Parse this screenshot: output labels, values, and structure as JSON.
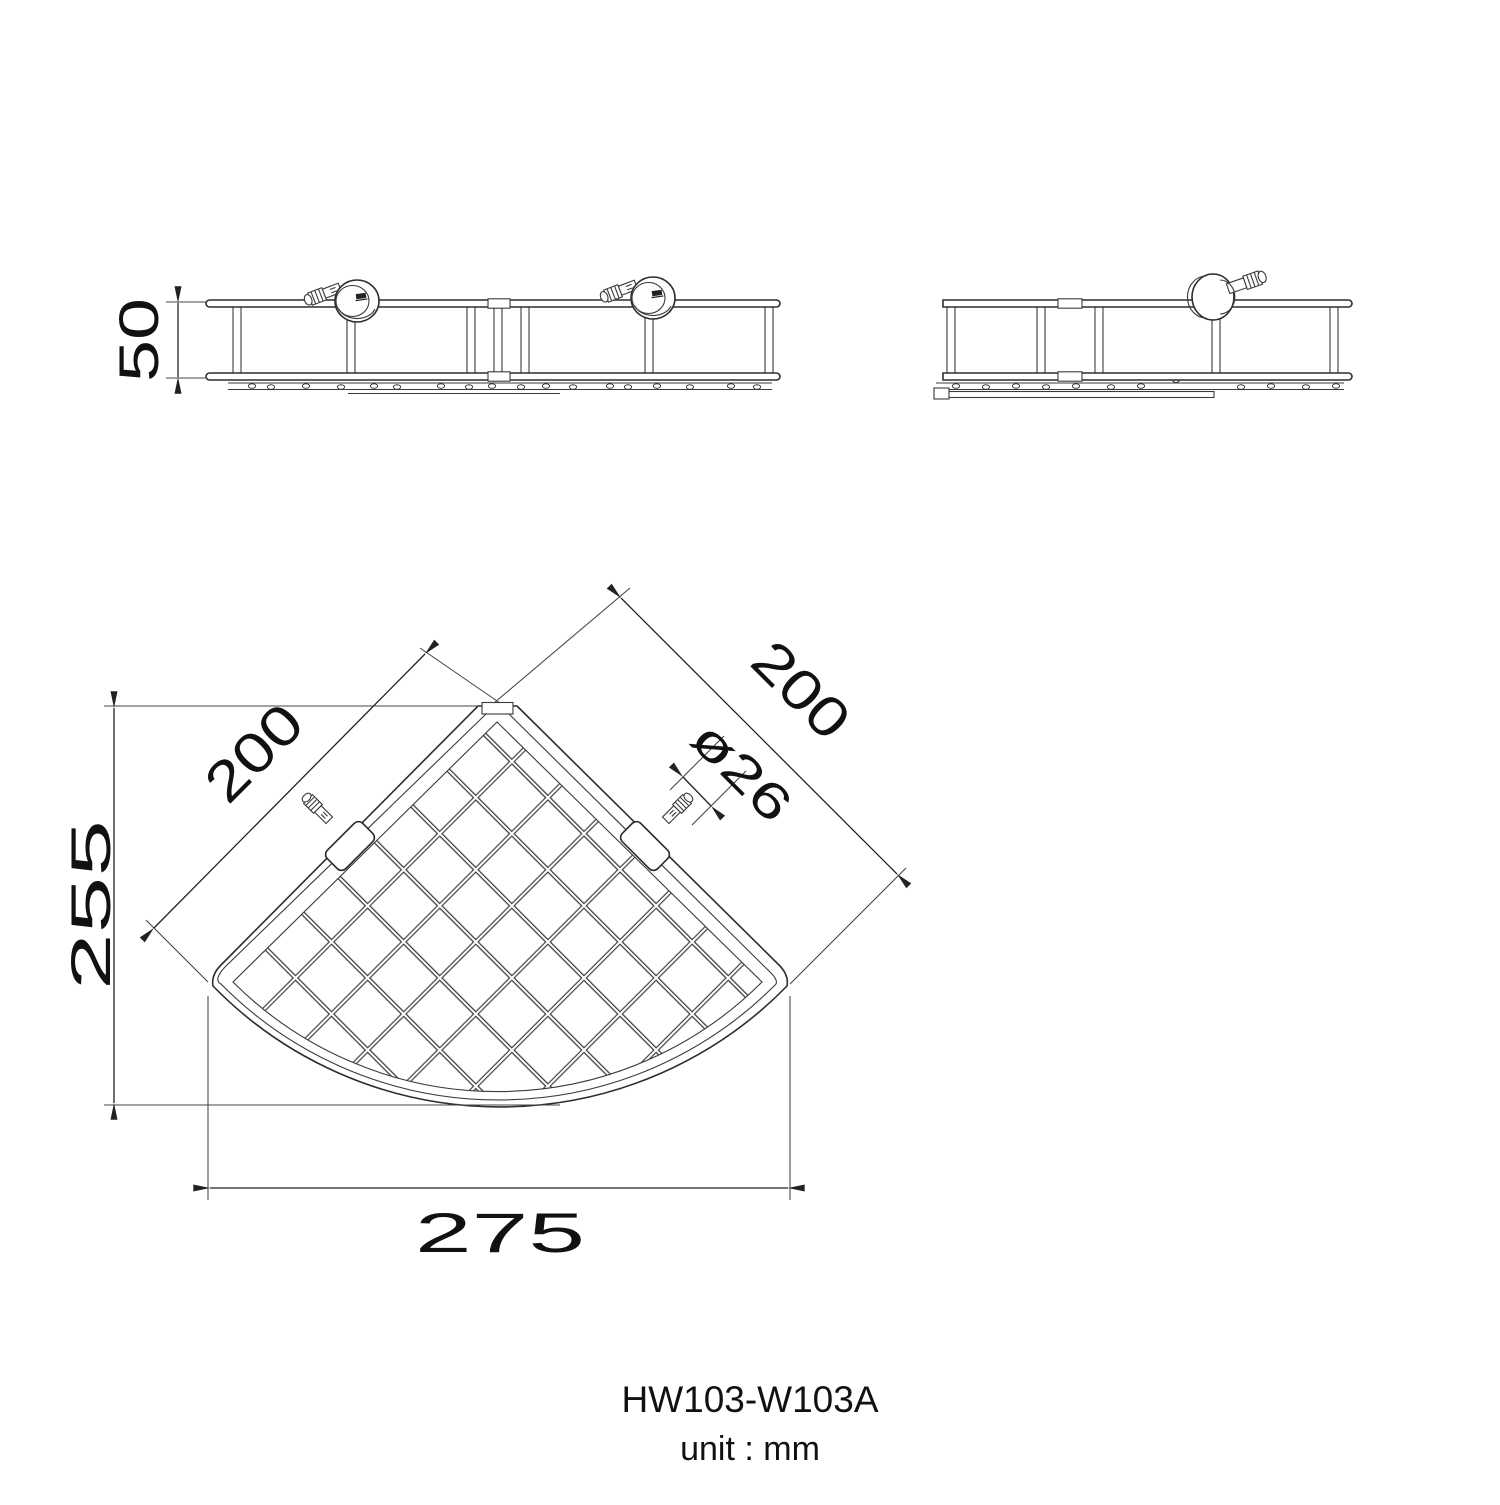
{
  "drawing": {
    "background": "#ffffff",
    "line_color": "#2d2d2d",
    "text_color": "#111111",
    "views": {
      "front": {
        "height_dim": "50"
      },
      "side": {},
      "plan": {
        "left_edge_dim": "200",
        "right_edge_dim": "200",
        "bracket_diameter_dim": "ø26",
        "depth_dim": "255",
        "width_dim": "275"
      }
    },
    "footer": {
      "model": "HW103-W103A",
      "unit": "unit : mm"
    }
  }
}
